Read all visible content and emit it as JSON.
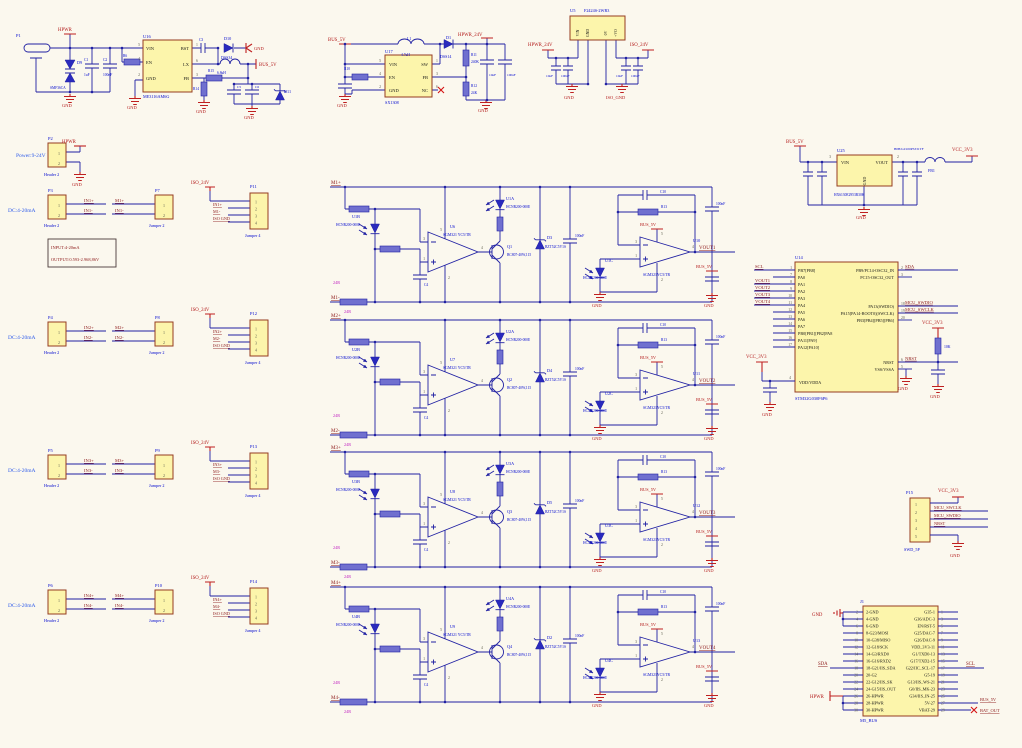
{
  "shared": {
    "hcnr": "HCNR200-000E",
    "op1v": "SGM321 YC5/TR",
    "op2v": "SGM321YC5/TR",
    "qv": "BC807-40W,115",
    "zv": "BZT52C5V1S",
    "capv": "100nF",
    "c4": "C4",
    "c10": "C10",
    "r13": "R13",
    "r24": "24R",
    "bus": "BUS_5V",
    "gnd": "GND",
    "iso": "ISO_24V",
    "isognd": "ISO GND",
    "dc": "DC:4-20mA",
    "hdr": "Header 2",
    "jp2": "Jumper 2",
    "jp4": "Jumper 4",
    "n1": "1",
    "n2": "2",
    "n3": "3",
    "n4": "4",
    "n5": "5"
  },
  "channels": [
    {
      "mp": "M1+",
      "mm": "M1-",
      "ua": "U1A",
      "ub": "U1B",
      "uc": "U1C",
      "op1": "U6",
      "op2": "U10",
      "q": "Q1",
      "d": "D3",
      "vout": "VOUT1"
    },
    {
      "mp": "M2+",
      "mm": "M2-",
      "ua": "U2A",
      "ub": "U2B",
      "uc": "U2C",
      "op1": "U7",
      "op2": "U11",
      "q": "Q2",
      "d": "D4",
      "vout": "VOUT2"
    },
    {
      "mp": "M3+",
      "mm": "M3-",
      "ua": "U3A",
      "ub": "U3B",
      "uc": "U3C",
      "op1": "U8",
      "op2": "U12",
      "q": "Q3",
      "d": "D5",
      "vout": "VOUT3"
    },
    {
      "mp": "M4+",
      "mm": "M4-",
      "ua": "U4A",
      "ub": "U4B",
      "uc": "U4C",
      "op1": "U9",
      "op2": "U13",
      "q": "Q4",
      "d": "D2",
      "vout": "VOUT4"
    }
  ],
  "rows": [
    {
      "p": "P3",
      "j2": "P7",
      "j4": "P11",
      "inp": "IN1+",
      "inm": "IN1-",
      "mp": "M1+",
      "mm": "M1-"
    },
    {
      "p": "P4",
      "j2": "P8",
      "j4": "P12",
      "inp": "IN2+",
      "inm": "IN2-",
      "mp": "M2+",
      "mm": "M2-"
    },
    {
      "p": "P5",
      "j2": "P9",
      "j4": "P13",
      "inp": "IN3+",
      "inm": "IN3-",
      "mp": "M3+",
      "mm": "M3-"
    },
    {
      "p": "P6",
      "j2": "P10",
      "j4": "P14",
      "inp": "IN4+",
      "inm": "IN4-",
      "mp": "M4+",
      "mm": "M4-"
    }
  ],
  "mcu": {
    "ref": "U14",
    "val": "STM32G030F6P6",
    "left": [
      {
        "num": "1",
        "name": "PB7[PB8]",
        "net": "SCL"
      },
      {
        "num": "7",
        "name": "PA0"
      },
      {
        "num": "8",
        "name": "PA1",
        "net": "VOUT1"
      },
      {
        "num": "9",
        "name": "PA2",
        "net": "VOUT2"
      },
      {
        "num": "10",
        "name": "PA3",
        "net": "VOUT3"
      },
      {
        "num": "11",
        "name": "PA4",
        "net": "VOUT4"
      },
      {
        "num": "12",
        "name": "PA5"
      },
      {
        "num": "13",
        "name": "PA6"
      },
      {
        "num": "14",
        "name": "PA7"
      },
      {
        "num": "15",
        "name": "PB0[PB1][PB2]PA8"
      },
      {
        "num": "16",
        "name": "PA11[PA9]"
      },
      {
        "num": "17",
        "name": "PA12[PA10]"
      }
    ],
    "right": [
      {
        "num": "2",
        "name": "PB9/PC14-OSC32_IN",
        "net": "SDA"
      },
      {
        "num": "3",
        "name": "PC15-OSC32_OUT"
      },
      {
        "num": "18",
        "name": "PA13(SWDIO)",
        "net": "MCU_SWDIO"
      },
      {
        "num": "19",
        "name": "PA15[PA14-BOOT0](SWCLK)",
        "net": "MCU_SWCLK"
      },
      {
        "num": "20",
        "name": "PB3[PB4][PB5][PB6]"
      },
      {
        "num": "6",
        "name": "NRST",
        "net": "NRST"
      },
      {
        "num": "5",
        "name": "VSS/VSSA"
      }
    ]
  },
  "h1": {
    "ref": "J1",
    "val": "M5_BUS",
    "left": [
      [
        "2",
        "2-GND"
      ],
      [
        "4",
        "4-GND"
      ],
      [
        "6",
        "6-GND"
      ],
      [
        "8",
        "8-G23/MOSI"
      ],
      [
        "10",
        "10-G38/MISO"
      ],
      [
        "12",
        "12-G18/SCK"
      ],
      [
        "14",
        "14-G3/RXD0"
      ],
      [
        "16",
        "16-G16/RXD2"
      ],
      [
        "18",
        "18-G21/IIS_SDA"
      ],
      [
        "20",
        "20-G2"
      ],
      [
        "22",
        "22-G12/IIS_SK"
      ],
      [
        "24",
        "24-G15/IIS_OUT"
      ],
      [
        "26",
        "26-HPWR"
      ],
      [
        "28",
        "28-HPWR"
      ],
      [
        "30",
        "30-HPWR"
      ]
    ],
    "right": [
      [
        "1",
        "G35-1"
      ],
      [
        "3",
        "G36/ADC-3"
      ],
      [
        "5",
        "EN/RST-5"
      ],
      [
        "7",
        "G25/DAC-7"
      ],
      [
        "9",
        "G26/DAC-9"
      ],
      [
        "11",
        "VDD_3V3-11"
      ],
      [
        "13",
        "G1/TXD0-13"
      ],
      [
        "15",
        "G17/TXD2-15"
      ],
      [
        "17",
        "G22/IIC_SCL-17"
      ],
      [
        "19",
        "G5-19"
      ],
      [
        "21",
        "G13/IIS_WS-21"
      ],
      [
        "23",
        "G0/IIS_MK-23"
      ],
      [
        "25",
        "G34/IIS_IN-25"
      ],
      [
        "27",
        "5V-27"
      ],
      [
        "29",
        "VBAT-29"
      ]
    ]
  },
  "labels": [
    [
      "p1-ref",
      16,
      37,
      "P1",
      "des",
      4.5,
      "s"
    ],
    [
      "hpwr-port-1",
      58,
      31,
      "HPWR",
      "pwr",
      4.8,
      "s"
    ],
    [
      "d9-ref",
      77,
      64,
      "D9",
      "des",
      4.2,
      "s"
    ],
    [
      "d9-val",
      50,
      89,
      "SMF36CA",
      "des",
      3.6,
      "s"
    ],
    [
      "c1-ref",
      84,
      61,
      "C1",
      "des",
      3.6,
      "s"
    ],
    [
      "c1-val",
      84,
      76,
      "1uF",
      "des",
      3.6,
      "s"
    ],
    [
      "c2-ref",
      103,
      61,
      "C2",
      "des",
      3.6,
      "s"
    ],
    [
      "c2-val",
      103,
      76,
      "100nF",
      "des",
      3.6,
      "s"
    ],
    [
      "r6-ref",
      123,
      57,
      "R6",
      "des",
      3.6,
      "s"
    ],
    [
      "u16-ref",
      143,
      38,
      "U16",
      "des",
      4.5,
      "s"
    ],
    [
      "u16-val",
      143,
      98,
      "ME3116AM6G",
      "des",
      4.2,
      "s"
    ],
    [
      "u16-pin-vin",
      146,
      50,
      "VIN",
      "pin",
      4.5,
      "s"
    ],
    [
      "u16-pin-en",
      146,
      64,
      "EN",
      "pin",
      4.5,
      "s"
    ],
    [
      "u16-pin-gnd",
      146,
      80,
      "GND",
      "pin",
      4.5,
      "s"
    ],
    [
      "u16-pin-bst",
      189,
      50,
      "BST",
      "pin",
      4.5,
      "e"
    ],
    [
      "u16-pin-lx",
      189,
      66,
      "LX",
      "pin",
      4.5,
      "e"
    ],
    [
      "u16-pin-fb",
      189,
      80,
      "FB",
      "pin",
      4.5,
      "e"
    ],
    [
      "u16-n5",
      140,
      46,
      "5",
      "num",
      3.8,
      "e"
    ],
    [
      "u16-n4",
      140,
      60,
      "4",
      "num",
      3.8,
      "e"
    ],
    [
      "u16-n2",
      140,
      76,
      "2",
      "num",
      3.8,
      "e"
    ],
    [
      "u16-n1",
      196,
      46,
      "1",
      "num",
      3.8,
      "s"
    ],
    [
      "u16-n6",
      196,
      62,
      "6",
      "num",
      3.8,
      "s"
    ],
    [
      "u16-n3",
      196,
      76,
      "3",
      "num",
      3.8,
      "s"
    ],
    [
      "c3-ref",
      199,
      41,
      "C3",
      "des",
      3.6,
      "s"
    ],
    [
      "d10-ref",
      224,
      40,
      "D10",
      "des",
      4.2,
      "s"
    ],
    [
      "d10-val",
      221,
      59,
      "DSS34",
      "des",
      4,
      "s"
    ],
    [
      "gnd-arrow-label",
      254,
      50,
      "GND",
      "pwr",
      4.5,
      "s"
    ],
    [
      "l0-val",
      217,
      74,
      "6.8uH",
      "des",
      3.6,
      "s"
    ],
    [
      "bus5v-port-1",
      259,
      66,
      "BUS_5V",
      "pwr",
      4.8,
      "s"
    ],
    [
      "r15-ref",
      208,
      72,
      "R15",
      "des",
      3.6,
      "s"
    ],
    [
      "r14-ref",
      199,
      90,
      "R14",
      "des",
      3.6,
      "e"
    ],
    [
      "c5-ref",
      237,
      88,
      "C5",
      "des",
      3.5,
      "s"
    ],
    [
      "c6-ref",
      255,
      88,
      "C6",
      "des",
      3.5,
      "s"
    ],
    [
      "d11-ref",
      284,
      93,
      "D11",
      "des",
      4.2,
      "s"
    ],
    [
      "gnd-1",
      62,
      107,
      "GND",
      "pwr",
      4.5,
      "s"
    ],
    [
      "gnd-2",
      127,
      109,
      "GND",
      "pwr",
      4.5,
      "s"
    ],
    [
      "gnd-3",
      196,
      113,
      "GND",
      "pwr",
      4.5,
      "s"
    ],
    [
      "gnd-4",
      244,
      119,
      "GND",
      "pwr",
      4.5,
      "s"
    ],
    [
      "bus5v-port-2",
      328,
      41,
      "BUS_5V",
      "pwr",
      4.8,
      "s"
    ],
    [
      "u17-ref",
      385,
      53,
      "U17",
      "des",
      4.5,
      "s"
    ],
    [
      "u17-val",
      385,
      104,
      "SX1308",
      "des",
      4.2,
      "s"
    ],
    [
      "u17-pin-vin",
      389,
      66,
      "VIN",
      "pin",
      4.5,
      "s"
    ],
    [
      "u17-pin-en",
      389,
      79,
      "EN",
      "pin",
      4.5,
      "s"
    ],
    [
      "u17-pin-gnd",
      389,
      92,
      "GND",
      "pin",
      4.5,
      "s"
    ],
    [
      "u17-pin-sw",
      428,
      66,
      "SW",
      "pin",
      4.5,
      "e"
    ],
    [
      "u17-pin-fb",
      428,
      79,
      "FB",
      "pin",
      4.5,
      "e"
    ],
    [
      "u17-pin-nc",
      428,
      92,
      "NC",
      "pin",
      4.5,
      "e"
    ],
    [
      "u17-n5",
      381,
      62,
      "5",
      "num",
      3.8,
      "e"
    ],
    [
      "u17-n4",
      381,
      75,
      "4",
      "num",
      3.8,
      "e"
    ],
    [
      "u17-n2",
      381,
      88,
      "2",
      "num",
      3.8,
      "e"
    ],
    [
      "u17-n1",
      436,
      62,
      "1",
      "num",
      3.8,
      "s"
    ],
    [
      "u17-n3",
      436,
      75,
      "3",
      "num",
      3.8,
      "s"
    ],
    [
      "u17-n6",
      436,
      88,
      "6",
      "num",
      3.8,
      "s"
    ],
    [
      "l1-ref",
      407,
      40,
      "L1",
      "des",
      3.8,
      "s"
    ],
    [
      "l1-val",
      401,
      56,
      "4.7uH",
      "des",
      3.6,
      "s"
    ],
    [
      "r10-ref",
      350,
      70,
      "R10",
      "des",
      3.6,
      "e"
    ],
    [
      "d1-ref",
      446,
      39,
      "D1",
      "des",
      4.2,
      "s"
    ],
    [
      "d1-val",
      440,
      58,
      "DSS14",
      "des",
      4,
      "s"
    ],
    [
      "hpwr24v-port-1",
      458,
      36,
      "HPWR_24V",
      "pwr",
      4.8,
      "s"
    ],
    [
      "r11-ref",
      471,
      56,
      "R11",
      "des",
      3.6,
      "s"
    ],
    [
      "r11-val",
      471,
      63,
      "240K",
      "des",
      3.6,
      "s"
    ],
    [
      "r12-ref",
      471,
      87,
      "R12",
      "des",
      3.6,
      "s"
    ],
    [
      "r12-val",
      471,
      94,
      "24K",
      "des",
      3.6,
      "s"
    ],
    [
      "c7-val",
      489,
      76,
      "10uF",
      "des",
      3.4,
      "s"
    ],
    [
      "c8-val",
      507,
      76,
      "100nF",
      "des",
      3.4,
      "s"
    ],
    [
      "gnd-5",
      337,
      107,
      "GND",
      "pwr",
      4.5,
      "s"
    ],
    [
      "gnd-6",
      478,
      112,
      "GND",
      "pwr",
      4.5,
      "s"
    ],
    [
      "u5-ref",
      570,
      12,
      "U5",
      "des",
      4.5,
      "s"
    ],
    [
      "u5-val",
      584,
      12,
      "F2424S-2WR3",
      "des",
      4.2,
      "s"
    ],
    [
      "u5-pin-vin",
      579,
      33,
      "VIN",
      "pin",
      3.8,
      "rm"
    ],
    [
      "u5-pin-gnd",
      589,
      33,
      "GND",
      "pin",
      3.8,
      "rm"
    ],
    [
      "u5-pin-0v",
      607,
      33,
      "0V",
      "pin",
      3.8,
      "rm"
    ],
    [
      "u5-pin-vo",
      617,
      33,
      "+VO",
      "pin",
      3.8,
      "rm"
    ],
    [
      "hpwr24v-port-2",
      528,
      46,
      "HPWR_24V",
      "pwr",
      4.8,
      "s"
    ],
    [
      "iso24v-port-top",
      630,
      46,
      "ISO_24V",
      "pwr",
      4.8,
      "s"
    ],
    [
      "u5-c1-val",
      546,
      77,
      "10uF",
      "des",
      3.4,
      "s"
    ],
    [
      "u5-c2-val",
      561,
      77,
      "100nF",
      "des",
      3.4,
      "s"
    ],
    [
      "u5-c3-val",
      616,
      77,
      "10uF",
      "des",
      3.4,
      "s"
    ],
    [
      "u5-c4-val",
      631,
      77,
      "100nF",
      "des",
      3.4,
      "s"
    ],
    [
      "gnd-7",
      564,
      99,
      "GND",
      "pwr",
      4.5,
      "s"
    ],
    [
      "isognd-1",
      606,
      99,
      "ISO_GND",
      "pwr",
      4.5,
      "s"
    ],
    [
      "bus5v-port-3",
      786,
      143,
      "BUS_5V",
      "pwr",
      4.8,
      "s"
    ],
    [
      "u25-ref",
      837,
      152,
      "U25",
      "des",
      4.5,
      "s"
    ],
    [
      "u25-pin-vin",
      841,
      164,
      "VIN",
      "pin",
      4.5,
      "s"
    ],
    [
      "u25-pin-vout",
      888,
      164,
      "VOUT",
      "pin",
      4.5,
      "e"
    ],
    [
      "u25-pin-gnd",
      866,
      181,
      "GND",
      "pin",
      4,
      "rm"
    ],
    [
      "u25-val",
      834,
      196,
      "HX6130E2953R30K",
      "des",
      3.6,
      "s"
    ],
    [
      "u25-n3",
      831,
      158,
      "3",
      "num",
      3.8,
      "e"
    ],
    [
      "u25-n2",
      897,
      158,
      "2",
      "num",
      3.8,
      "s"
    ],
    [
      "fb1-val",
      894,
      150,
      "B0B/GZ100PS331TF",
      "des",
      3.4,
      "s"
    ],
    [
      "fb1-ref",
      928,
      172,
      "FB1",
      "des",
      4,
      "s"
    ],
    [
      "vcc3v3-port-1",
      952,
      151,
      "VCC_3V3",
      "pwr",
      4.8,
      "s"
    ],
    [
      "gnd-8",
      856,
      219,
      "GND",
      "pwr",
      4.5,
      "s"
    ],
    [
      "power-range-label",
      16,
      157,
      "Power:9-24V",
      "blue-lt",
      5.5,
      "s"
    ],
    [
      "p2-ref",
      48,
      140,
      "P2",
      "des",
      4.5,
      "s"
    ],
    [
      "p2-val",
      44,
      176,
      "Header 2",
      "des",
      4.2,
      "s"
    ],
    [
      "hpwr-port-2",
      62,
      143,
      "HPWR",
      "pwr",
      4.8,
      "s"
    ],
    [
      "gnd-9",
      72,
      186,
      "GND",
      "pwr",
      4.5,
      "s"
    ],
    [
      "p2-n1",
      59,
      155,
      "1",
      "num",
      4,
      "m"
    ],
    [
      "p2-n2",
      59,
      165,
      "2",
      "num",
      4,
      "m"
    ],
    [
      "spec-line-1",
      51,
      249,
      "INPUT:4-20mA",
      "net2",
      4.4,
      "s"
    ],
    [
      "spec-line-2",
      51,
      261,
      "OUTPUT:0.593-2.968,86V",
      "net2",
      4.4,
      "s"
    ],
    [
      "vcc3v3-port-2",
      746,
      358,
      "VCC_3V3",
      "pwr",
      4.8,
      "s"
    ],
    [
      "gnd-10",
      762,
      416,
      "GND",
      "pwr",
      4.5,
      "s"
    ],
    [
      "vcc3v3-port-3",
      922,
      324,
      "VCC_3V3",
      "pwr",
      4.8,
      "s"
    ],
    [
      "r17-val",
      944,
      348,
      "10K",
      "des",
      3.8,
      "s"
    ],
    [
      "gnd-11",
      930,
      398,
      "GND",
      "pwr",
      4.5,
      "s"
    ],
    [
      "gnd-12",
      898,
      390,
      "GND",
      "pwr",
      4.5,
      "s"
    ],
    [
      "u14-n4",
      791,
      379,
      "4",
      "num",
      3.8,
      "e"
    ],
    [
      "u14-pin-vdd",
      799,
      384,
      "VDD/VDDA",
      "pin",
      4.2,
      "s"
    ],
    [
      "p15-ref",
      906,
      494,
      "P15",
      "des",
      4.5,
      "s"
    ],
    [
      "p15-val",
      904,
      551,
      "SWD_5P",
      "des",
      4.2,
      "s"
    ],
    [
      "vcc3v3-port-4",
      938,
      492,
      "VCC_3V3",
      "pwr",
      4.8,
      "s"
    ],
    [
      "gnd-13",
      950,
      557,
      "GND",
      "pwr",
      4.5,
      "s"
    ],
    [
      "p15-n1",
      916,
      506,
      "1",
      "num",
      4,
      "m"
    ],
    [
      "p15-n2",
      916,
      514,
      "2",
      "num",
      4,
      "m"
    ],
    [
      "p15-n3",
      916,
      522,
      "3",
      "num",
      4,
      "m"
    ],
    [
      "p15-n4",
      916,
      530,
      "4",
      "num",
      4,
      "m"
    ],
    [
      "p15-n5",
      916,
      538,
      "5",
      "num",
      4,
      "m"
    ],
    [
      "p15-net-swclk",
      934,
      509,
      "MCU_SWCLK",
      "net",
      4.4,
      "s"
    ],
    [
      "p15-net-swdio",
      934,
      517,
      "MCU_SWDIO",
      "net",
      4.4,
      "s"
    ],
    [
      "p15-net-nrst",
      934,
      525,
      "NRST",
      "net",
      4.4,
      "s"
    ],
    [
      "h1-ref",
      860,
      603,
      "J1",
      "des",
      4.5,
      "s"
    ],
    [
      "h1-val",
      860,
      722,
      "M5_BUS",
      "des",
      4.5,
      "s"
    ],
    [
      "h1-net-gnd",
      812,
      616,
      "GND",
      "pwr",
      4.8,
      "s"
    ],
    [
      "h1-net-sda",
      818,
      665,
      "SDA",
      "net",
      4.8,
      "s"
    ],
    [
      "h1-net-hpwr",
      810,
      698,
      "HPWR",
      "pwr",
      4.8,
      "s"
    ],
    [
      "h1-net-scl",
      966,
      665,
      "SCL",
      "net",
      4.8,
      "s"
    ],
    [
      "h1-net-bus5v",
      980,
      701,
      "BUS_5V",
      "net",
      4.4,
      "s"
    ],
    [
      "h1-net-batout",
      980,
      712,
      "BAT_OUT",
      "net",
      4.4,
      "s"
    ]
  ]
}
